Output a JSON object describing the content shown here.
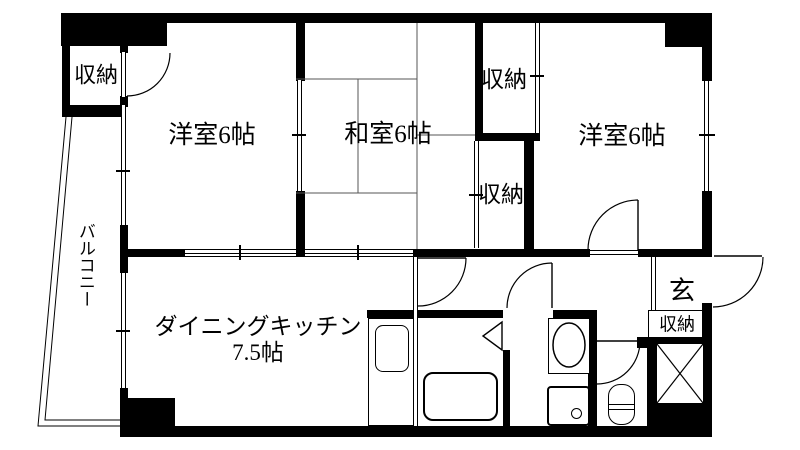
{
  "floorplan": {
    "type": "japanese-apartment-floor-plan",
    "colors": {
      "wall": "#000000",
      "background": "#ffffff",
      "line": "#000000"
    },
    "rooms": {
      "balcony": {
        "label": "バルコニー"
      },
      "western_room_left": {
        "label": "洋室6帖"
      },
      "japanese_room": {
        "label": "和室6帖"
      },
      "western_room_right": {
        "label": "洋室6帖"
      },
      "dining_kitchen": {
        "label": "ダイニングキッチン",
        "size": "7.5帖"
      },
      "entrance": {
        "label": "玄"
      },
      "closet_top_left": {
        "label": "収納"
      },
      "closet_upper_middle": {
        "label": "収納"
      },
      "closet_lower_middle": {
        "label": "収納"
      },
      "closet_entrance": {
        "label": "収納"
      }
    }
  }
}
